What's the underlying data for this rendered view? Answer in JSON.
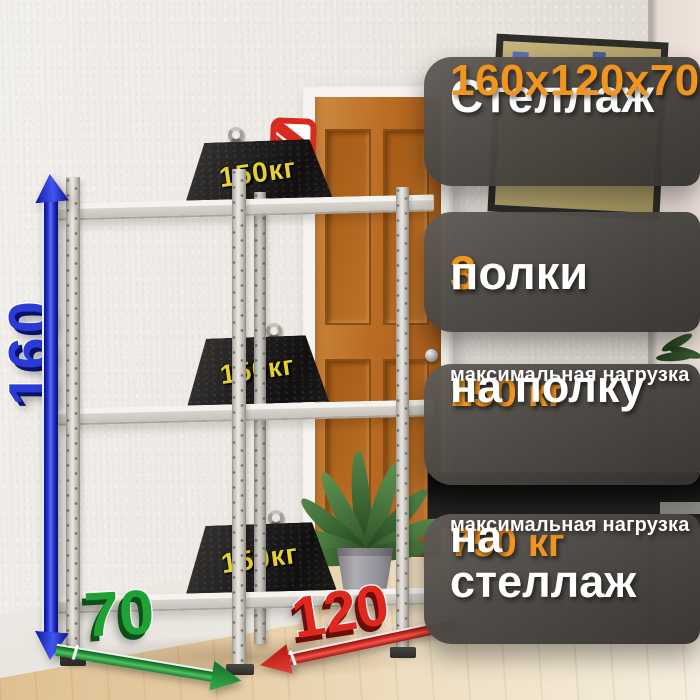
{
  "product": {
    "name": "Стеллаж",
    "dimensions": "160х120х70",
    "shelves_count": "3",
    "shelves_word": "полки",
    "shelf_load": {
      "value": "150 кг",
      "caption": "максимальная нагрузка",
      "target": "на полку"
    },
    "rack_load": {
      "value": "750 кг",
      "caption": "максимальная нагрузка",
      "target": "на стеллаж"
    }
  },
  "measurements": {
    "height": "160",
    "depth": "70",
    "width": "120"
  },
  "weight_blocks": {
    "label": "150кг",
    "count": 3
  },
  "colors": {
    "accent_orange": "#F2951F",
    "panel_dark": "#4A4642",
    "height_arrow_blue": "#2B3BD8",
    "depth_arrow_green": "#1FA136",
    "width_arrow_red": "#E0281F",
    "weight_label_yellow": "#E6D22F",
    "door_wood": "#B96D24"
  },
  "icons": {
    "brand_logo": "red-rounded-square-with-diagonal-stripes",
    "lifting_eye": "metal-ring-hook"
  }
}
